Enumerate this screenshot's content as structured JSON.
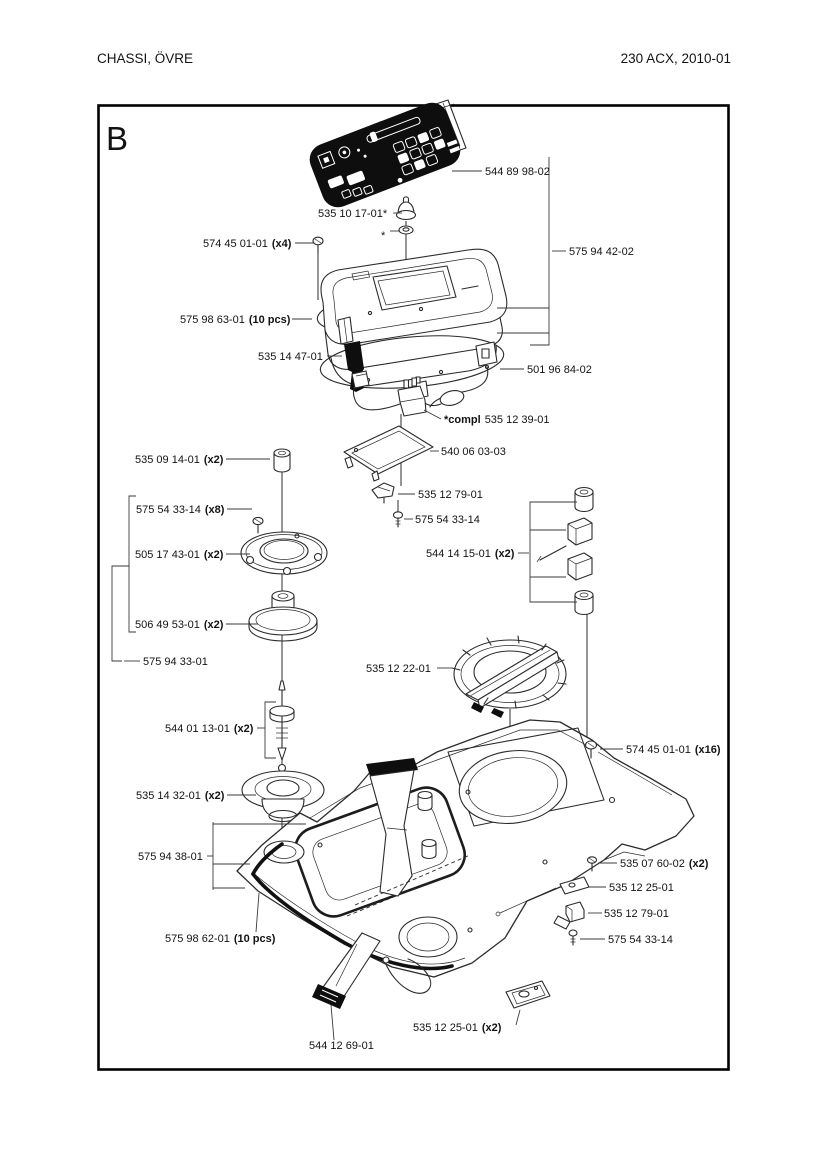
{
  "page": {
    "header_left": "CHASSI, ÖVRE",
    "header_right": "230 ACX, 2010-01",
    "section_letter": "B"
  },
  "diagram": {
    "labels": [
      {
        "num": "544 89 98-02"
      },
      {
        "num": "535 10 17-01*"
      },
      {
        "num": "*"
      },
      {
        "num": "574 45 01-01",
        "qty": "(x4)"
      },
      {
        "num": "575 94 42-02"
      },
      {
        "num": "575 98 63-01",
        "qty": "(10 pcs)"
      },
      {
        "num": "535 14 47-01"
      },
      {
        "num": "501 96 84-02"
      },
      {
        "prefix": "*compl",
        "num": "535 12 39-01"
      },
      {
        "num": "540 06 03-03"
      },
      {
        "num": "535 09 14-01",
        "qty": "(x2)"
      },
      {
        "num": "535 12 79-01"
      },
      {
        "num": "575 54 33-14",
        "qty": "(x8)"
      },
      {
        "num": "575 54 33-14"
      },
      {
        "num": "544 14 15-01",
        "qty": "(x2)"
      },
      {
        "num": "505 17 43-01",
        "qty": "(x2)"
      },
      {
        "num": "506 49 53-01",
        "qty": "(x2)"
      },
      {
        "num": "575 94 33-01"
      },
      {
        "num": "535 12 22-01"
      },
      {
        "num": "544 01 13-01",
        "qty": "(x2)"
      },
      {
        "num": "574 45 01-01",
        "qty": "(x16)"
      },
      {
        "num": "535 14 32-01",
        "qty": "(x2)"
      },
      {
        "num": "575 94 38-01"
      },
      {
        "num": "535 07 60-02",
        "qty": "(x2)"
      },
      {
        "num": "535 12 25-01"
      },
      {
        "num": "535 12 79-01"
      },
      {
        "num": "575 98 62-01",
        "qty": "(10 pcs)"
      },
      {
        "num": "575 54 33-14"
      },
      {
        "num": "535 12 25-01",
        "qty": "(x2)"
      },
      {
        "num": "544 12 69-01"
      }
    ]
  }
}
